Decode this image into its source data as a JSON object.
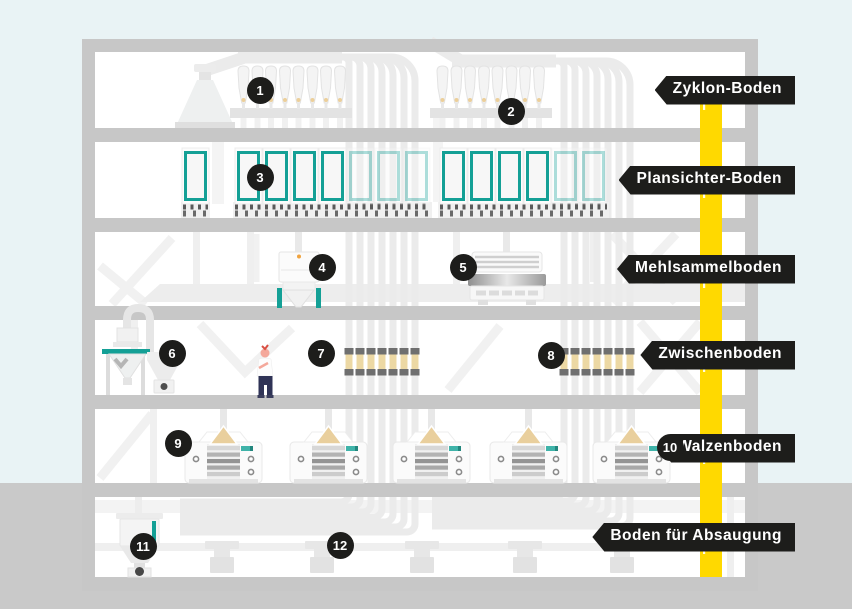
{
  "diagram": {
    "floors": [
      {
        "label": "Zyklon-Boden"
      },
      {
        "label": "Plansichter-Boden"
      },
      {
        "label": "Mehlsammelboden"
      },
      {
        "label": "Zwischenboden"
      },
      {
        "label": "Walzenboden"
      },
      {
        "label": "Boden für Absaugung"
      }
    ],
    "badges": [
      "1",
      "2",
      "3",
      "4",
      "5",
      "6",
      "7",
      "8",
      "9",
      "10",
      "11",
      "12"
    ],
    "colors": {
      "sky": "#e9f3f5",
      "structure_gray": "#c7c7c7",
      "pipe_light": "#ebebeb",
      "accent_teal": "#14a096",
      "elevator_yellow": "#ffd900",
      "grain_tan": "#ecd8a4",
      "tag_black": "#1d1d1b"
    }
  }
}
